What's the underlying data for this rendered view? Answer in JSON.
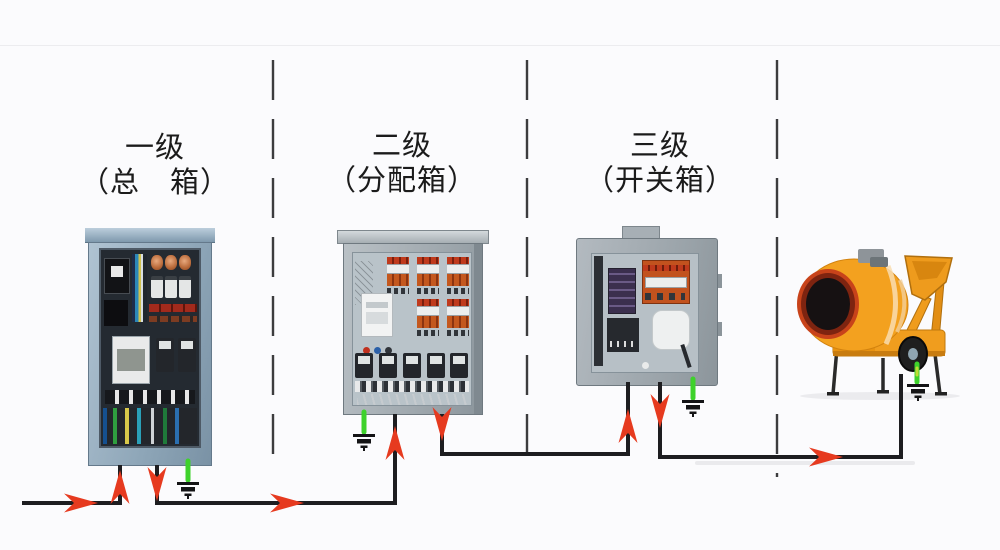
{
  "labels": {
    "level1": {
      "line1": "一级",
      "line2": "（总　箱）"
    },
    "level2": {
      "line1": "二级",
      "line2": "（分配箱）"
    },
    "level3": {
      "line1": "三级",
      "line2": "（开关箱）"
    }
  },
  "colors": {
    "background": "#fbfbfd",
    "wire": "#1d1d20",
    "arrow": "#e63a1f",
    "ground_wire": "#3ed22b",
    "dashed_divider": "#3c3c3e",
    "cabinet_blue": "#8fa6b9",
    "cabinet_gray": "#a0a9af",
    "mixer_orange": "#f09c1e"
  }
}
